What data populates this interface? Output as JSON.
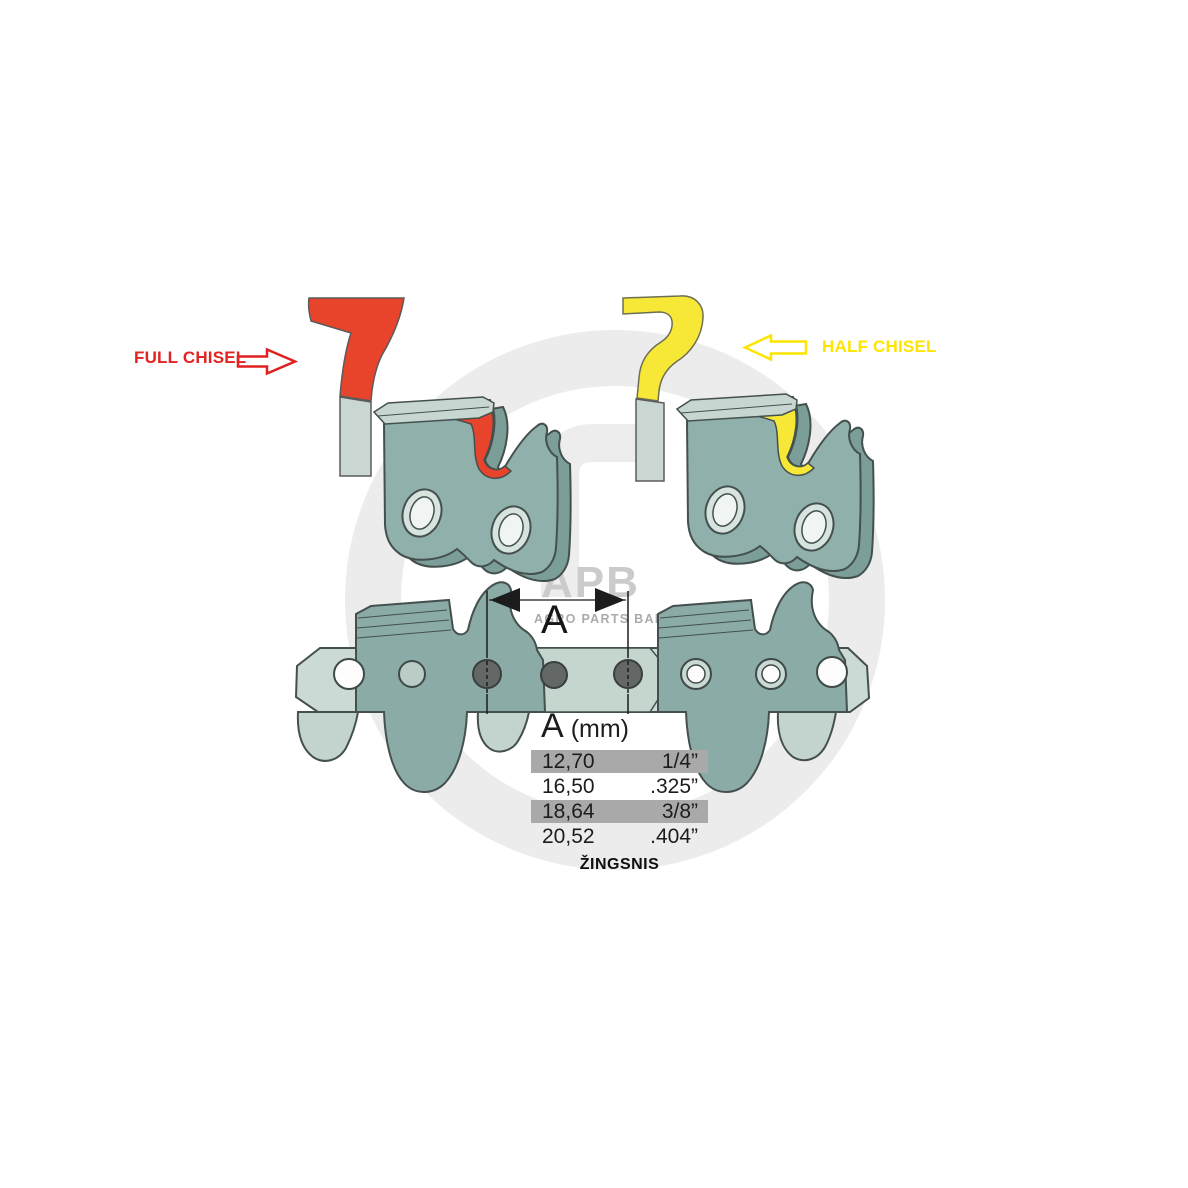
{
  "labels": {
    "full_chisel": "FULL CHISEL",
    "half_chisel": "HALF CHISEL",
    "dimension_letter": "A",
    "pitch_caption": "ŽINGSNIS"
  },
  "pitch_table": {
    "header_letter": "A",
    "header_unit": "(mm)",
    "rows": [
      {
        "mm": "12,70",
        "inch": "1/4”",
        "highlighted": true
      },
      {
        "mm": "16,50",
        "inch": ".325”",
        "highlighted": false
      },
      {
        "mm": "18,64",
        "inch": "3/8”",
        "highlighted": true
      },
      {
        "mm": "20,52",
        "inch": ".404”",
        "highlighted": false
      }
    ]
  },
  "watermark": {
    "logo": "APB",
    "subtitle": "AGRO PARTS BALTIJA"
  },
  "colors": {
    "full_chisel_red": "#E8432B",
    "half_chisel_yellow": "#F7E838",
    "label_red": "#E32222",
    "label_yellow": "#FFE400",
    "cutter_teal": "#8FB0AB",
    "cutter_teal_dark": "#7C9E99",
    "plate_light": "#C7D6D1",
    "chain_plate": "#CBDAD4",
    "chain_cutter": "#8AABA6",
    "rivet_gray": "#636766",
    "outline": "#44504D",
    "table_row_gray": "#A9A9A9",
    "watermark_gray": "#ECECEC",
    "text_dark": "#1D1D1D"
  }
}
